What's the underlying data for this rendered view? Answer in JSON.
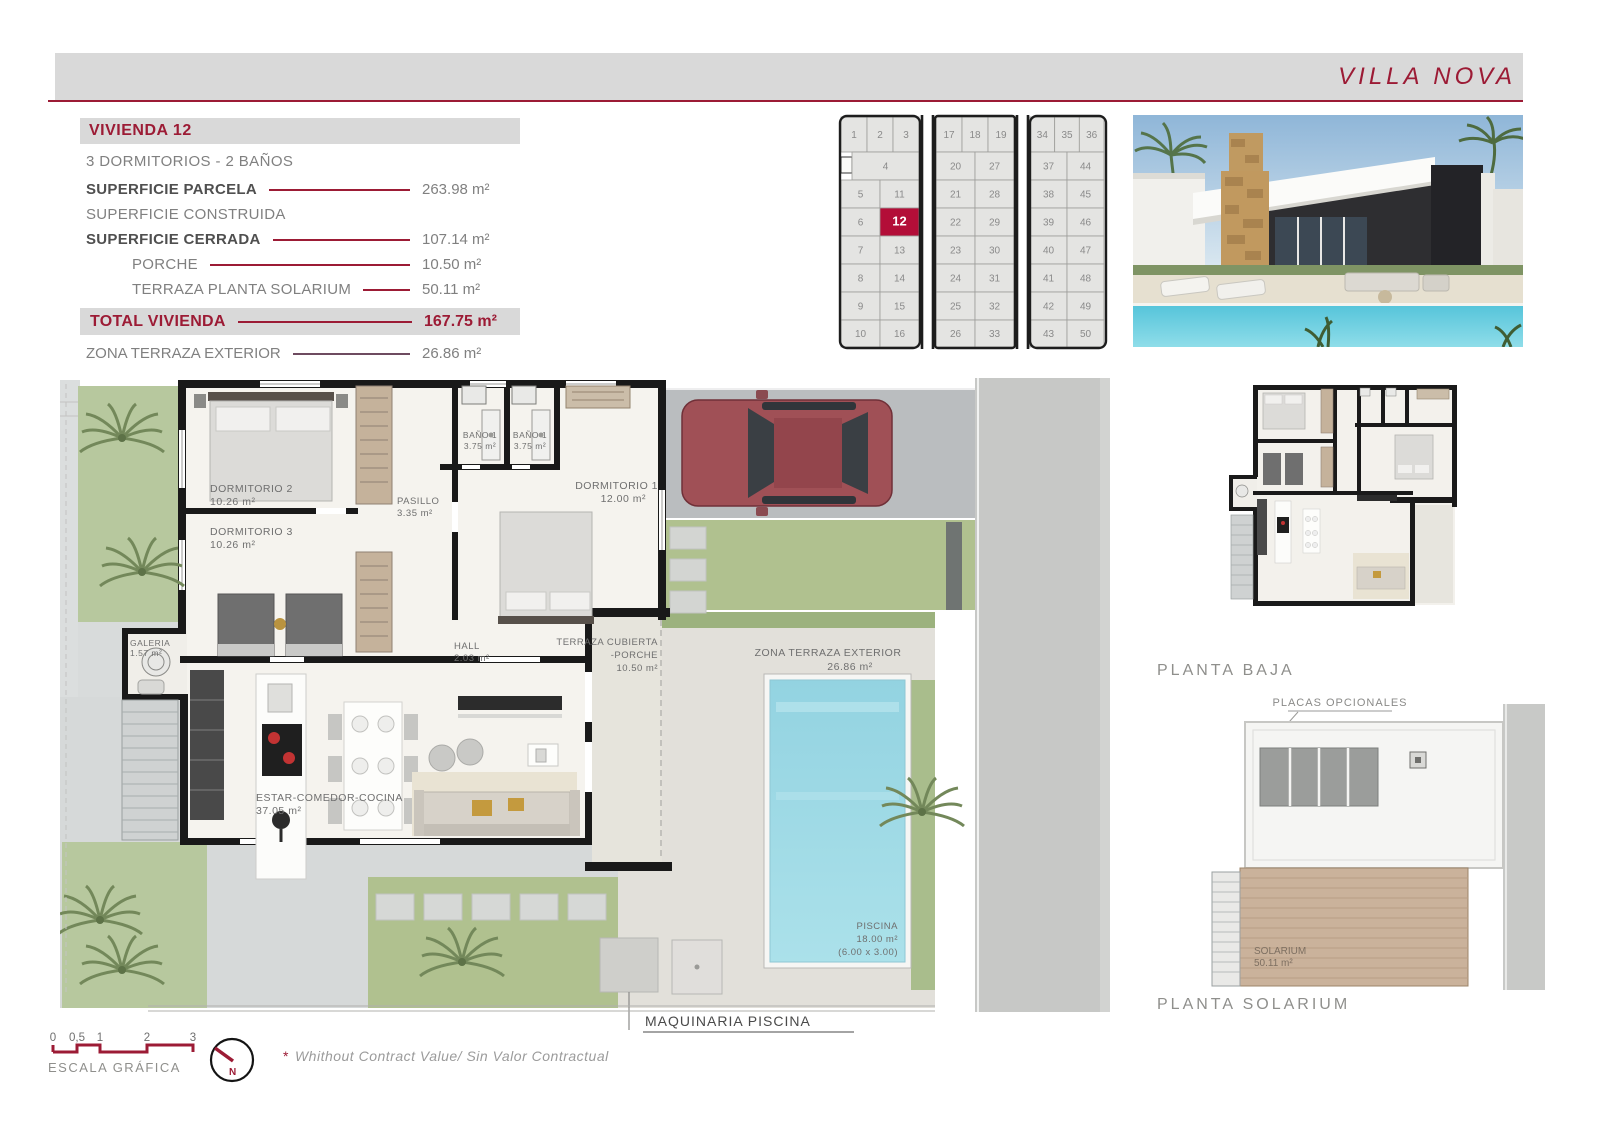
{
  "page": {
    "title": "VILLA NOVA"
  },
  "colors": {
    "accent": "#9c1b35",
    "plot_red": "#b30e38",
    "band_gray": "#d9d9d9",
    "text_gray": "#7f7f7f",
    "text_dark": "#4f4f4f",
    "wall_black": "#191919",
    "garden_green": "#b7c89e",
    "road_gray": "#c7c8c6",
    "pool_blue": "#9fd9e5"
  },
  "specs": {
    "header": "VIVIENDA 12",
    "subtitle": "3 DORMITORIOS - 2 BAÑOS",
    "rows": [
      {
        "label": "SUPERFICIE PARCELA",
        "value": "263.98 m²",
        "bold": true,
        "indent": false
      },
      {
        "label": "SUPERFICIE CONSTRUIDA",
        "value": "",
        "bold": false,
        "indent": false
      },
      {
        "label": "SUPERFICIE CERRADA",
        "value": "107.14 m²",
        "bold": true,
        "indent": false
      },
      {
        "label": "PORCHE",
        "value": "10.50 m²",
        "bold": false,
        "indent": true
      },
      {
        "label": "TERRAZA PLANTA SOLARIUM",
        "value": "50.11 m²",
        "bold": false,
        "indent": true
      }
    ],
    "total": {
      "label": "TOTAL VIVIENDA",
      "value": "167.75 m²"
    },
    "extra": {
      "label": "ZONA TERRAZA EXTERIOR",
      "value": "26.86 m²"
    }
  },
  "site_plan": {
    "highlight": "12",
    "blocks": [
      {
        "rows": [
          [
            "1",
            "2",
            "3"
          ],
          [
            "4"
          ],
          [
            "5",
            "11"
          ],
          [
            "6",
            "12"
          ],
          [
            "7",
            "13"
          ],
          [
            "8",
            "14"
          ],
          [
            "9",
            "15"
          ],
          [
            "10",
            "16"
          ]
        ]
      },
      {
        "rows": [
          [
            "17",
            "18",
            "19"
          ],
          [
            "20",
            "27"
          ],
          [
            "21",
            "28"
          ],
          [
            "22",
            "29"
          ],
          [
            "23",
            "30"
          ],
          [
            "24",
            "31"
          ],
          [
            "25",
            "32"
          ],
          [
            "26",
            "33"
          ]
        ]
      },
      {
        "rows": [
          [
            "34",
            "35",
            "36"
          ],
          [
            "37",
            "44"
          ],
          [
            "38",
            "45"
          ],
          [
            "39",
            "46"
          ],
          [
            "40",
            "47"
          ],
          [
            "41",
            "48"
          ],
          [
            "42",
            "49"
          ],
          [
            "43",
            "50"
          ]
        ]
      }
    ]
  },
  "floor_plan": {
    "dormitorio2": {
      "name": "DORMITORIO 2",
      "area": "10.26 m²"
    },
    "dormitorio3": {
      "name": "DORMITORIO 3",
      "area": "10.26 m²"
    },
    "bano1a": {
      "name": "BAÑO 1",
      "area": "3.75 m²"
    },
    "bano1b": {
      "name": "BAÑO 1",
      "area": "3.75 m²"
    },
    "pasillo": {
      "name": "PASILLO",
      "area": "3.35 m²"
    },
    "dormitorio1": {
      "name": "DORMITORIO 1",
      "area": "12.00 m²"
    },
    "galeria": {
      "name": "GALERIA",
      "area": "1.57 m²"
    },
    "hall": {
      "name": "HALL",
      "area": "2.03 m²"
    },
    "estar": {
      "name": "ESTAR-COMEDOR-COCINA",
      "area": "37.05 m²"
    },
    "terraza_cubierta": {
      "line1": "TERRAZA CUBIERTA",
      "line2": "-PORCHE",
      "area": "10.50 m²"
    },
    "zona_terraza": {
      "name": "ZONA TERRAZA EXTERIOR",
      "area": "26.86 m²"
    },
    "piscina": {
      "name": "PISCINA",
      "area": "18.00 m²",
      "dims": "(6.00 x 3.00)"
    },
    "maquinaria": "MAQUINARIA PISCINA"
  },
  "mini_plans": {
    "planta_baja": "PLANTA BAJA",
    "placas": "PLACAS OPCIONALES",
    "solarium": {
      "name": "SOLARIUM",
      "area": "50.11 m²"
    },
    "planta_solarium": "PLANTA SOLARIUM"
  },
  "footer": {
    "scale_ticks": [
      "0",
      "0,5",
      "1",
      "2",
      "3"
    ],
    "scale_label": "ESCALA GRÁFICA",
    "north": "N",
    "note_mark": "*",
    "note": "Whithout Contract Value/ Sin Valor Contractual"
  }
}
